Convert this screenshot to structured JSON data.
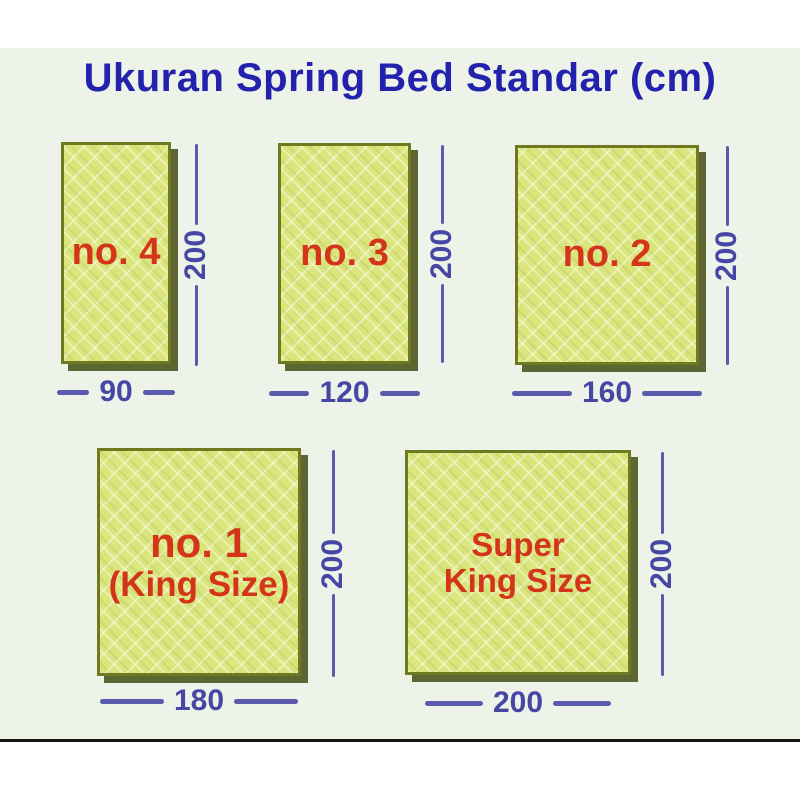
{
  "title": "Ukuran Spring Bed Standar (cm)",
  "unit": "cm",
  "colors": {
    "title_blue": "#2222ad",
    "label_red": "#d43419",
    "dimension_blue": "#5a5aad",
    "bed_fill": "#dae67c",
    "bed_border": "#6e7920",
    "background_tint": "#eef3e9",
    "page_white": "#ffffff",
    "bottom_rule": "#161616"
  },
  "beds": [
    {
      "id": "no-4",
      "label_line1": "no. 4",
      "label_line2": "",
      "width_cm": "90",
      "height_cm": "200"
    },
    {
      "id": "no-3",
      "label_line1": "no. 3",
      "label_line2": "",
      "width_cm": "120",
      "height_cm": "200"
    },
    {
      "id": "no-2",
      "label_line1": "no. 2",
      "label_line2": "",
      "width_cm": "160",
      "height_cm": "200"
    },
    {
      "id": "no-1-king",
      "label_line1": "no. 1",
      "label_line2": "(King Size)",
      "width_cm": "180",
      "height_cm": "200"
    },
    {
      "id": "super-king",
      "label_line1": "Super",
      "label_line2": "King Size",
      "width_cm": "200",
      "height_cm": "200"
    }
  ]
}
